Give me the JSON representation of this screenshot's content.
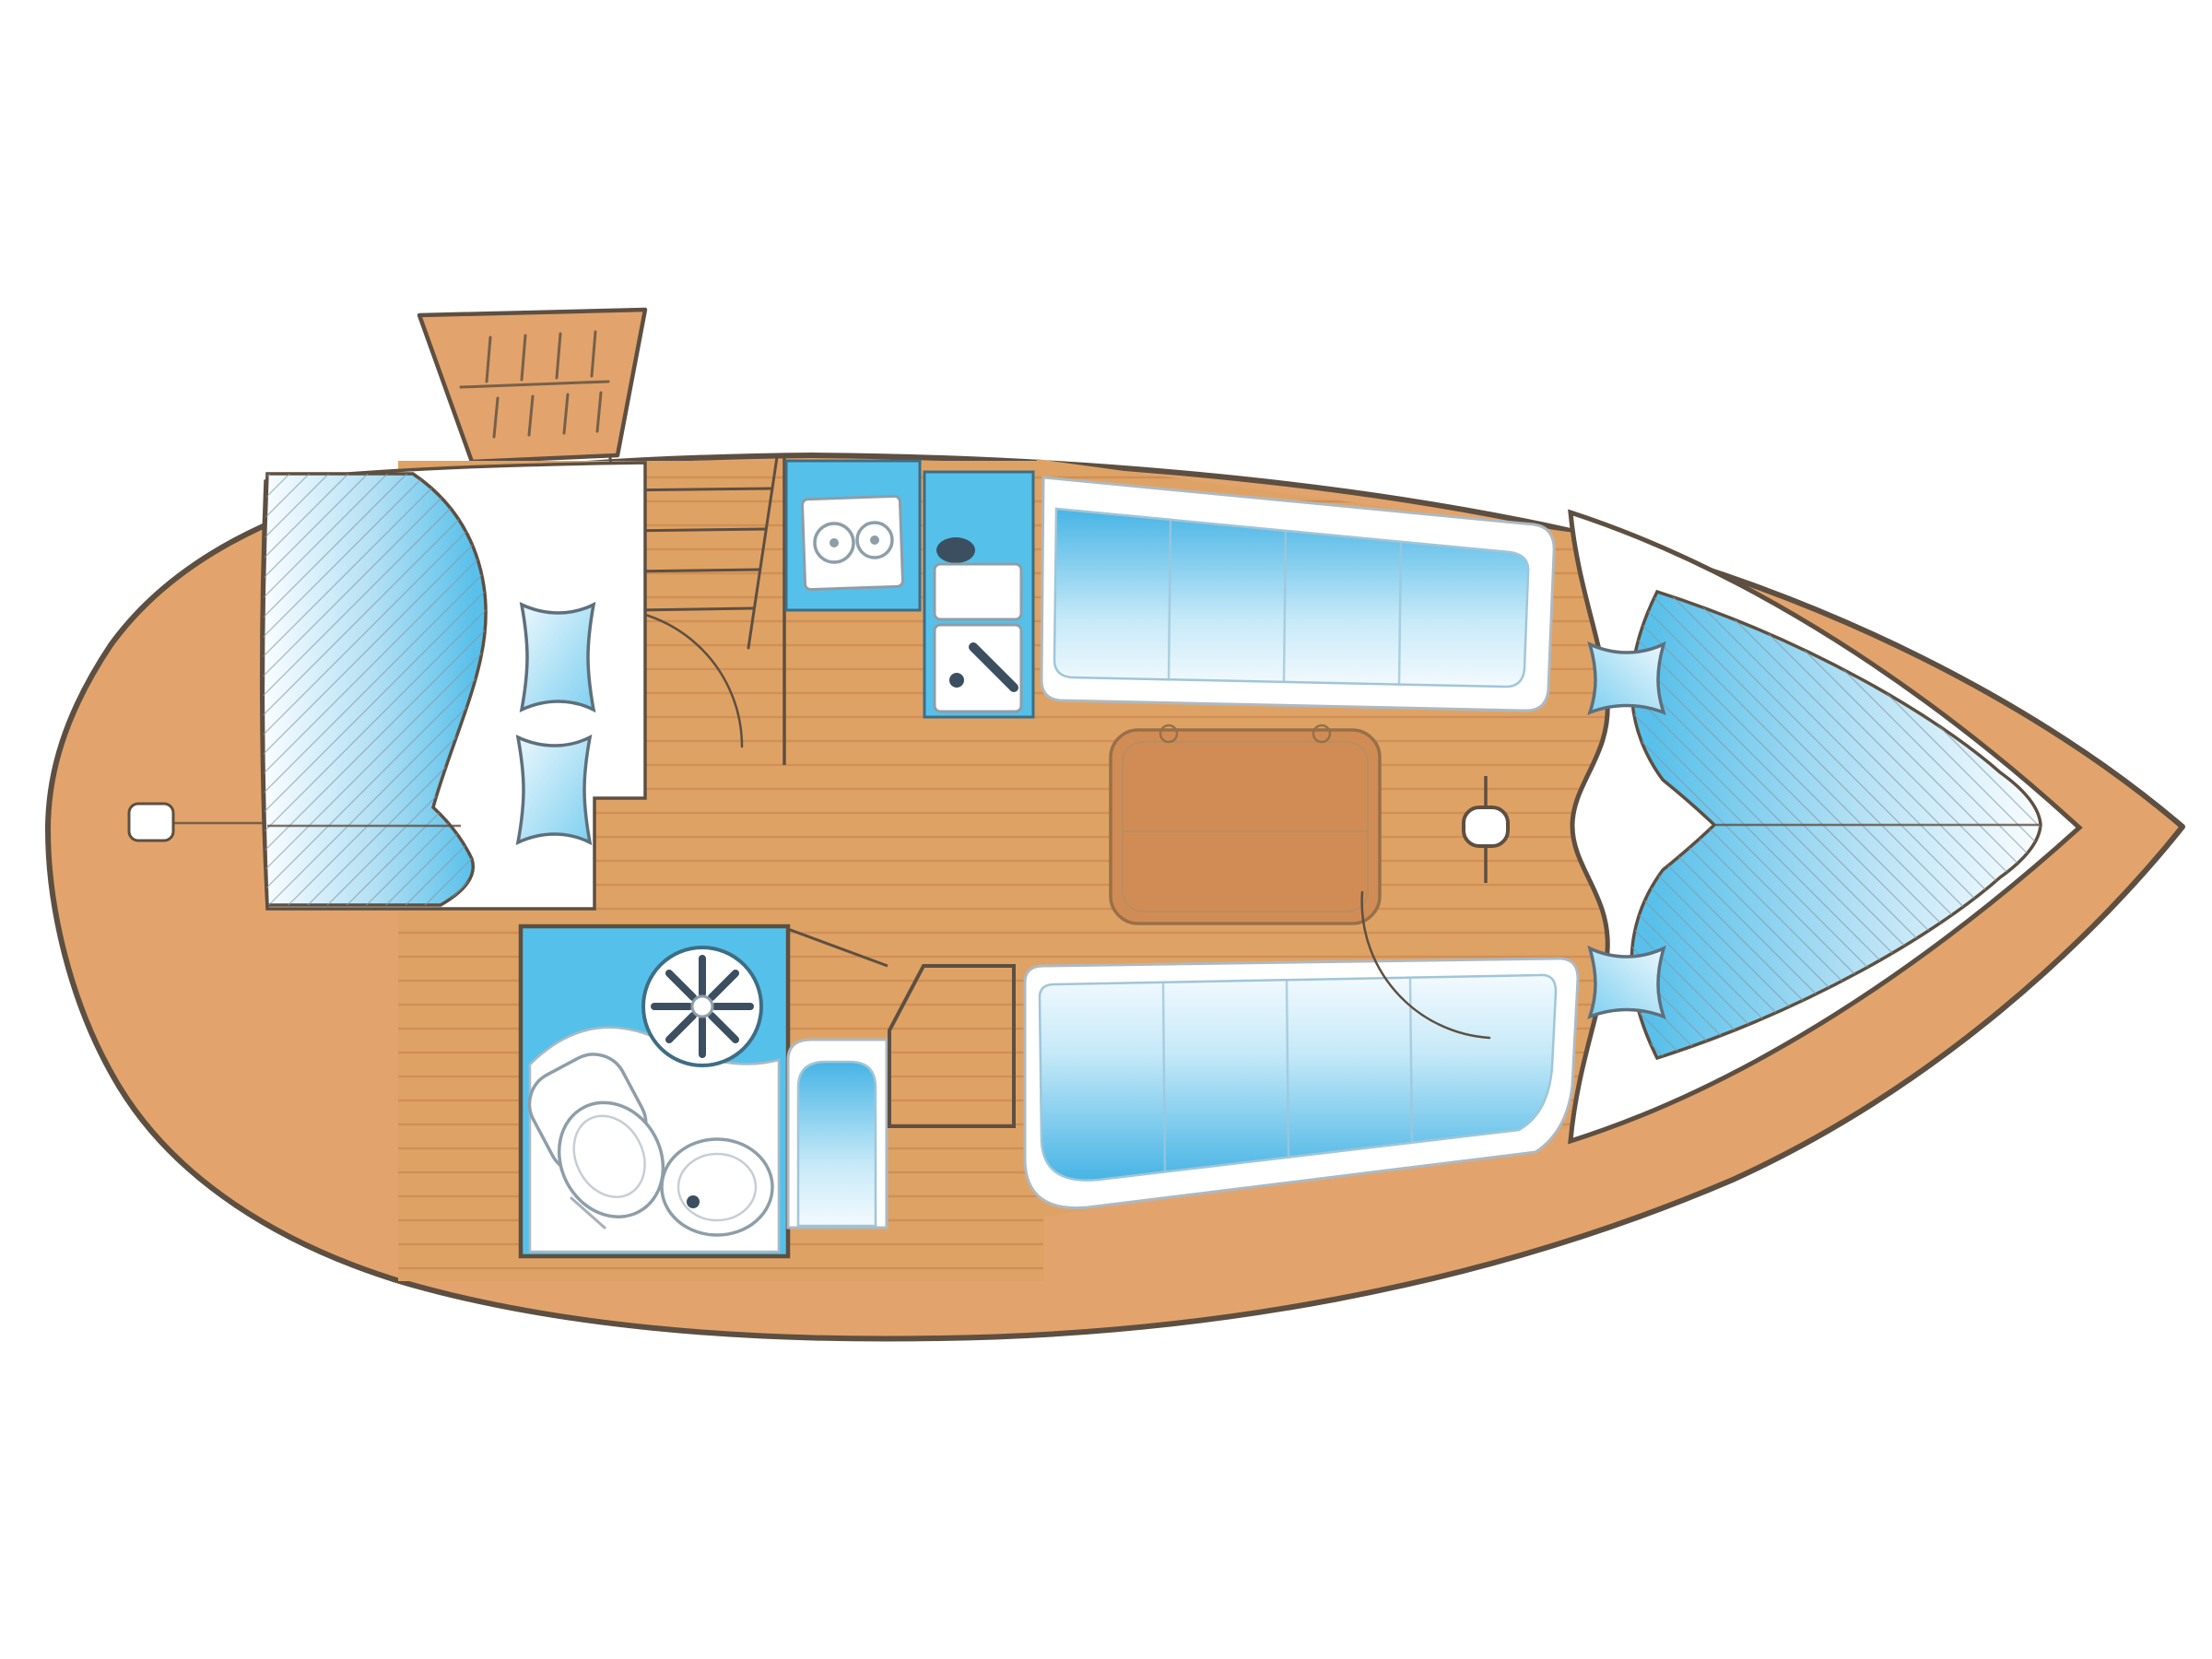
{
  "diagram": {
    "type": "boat-interior-floor-plan",
    "orientation": "bow-right",
    "areas": [
      {
        "id": "hull",
        "label": "hull"
      },
      {
        "id": "cockpit-hatch",
        "label": "companionway hatch"
      },
      {
        "id": "companionway-steps",
        "label": "companionway steps"
      },
      {
        "id": "aft-cabin-berth",
        "label": "aft double berth"
      },
      {
        "id": "heads",
        "label": "heads / bathroom"
      },
      {
        "id": "shower-drain",
        "label": "shower drain wheel"
      },
      {
        "id": "toilet",
        "label": "toilet"
      },
      {
        "id": "washbasin",
        "label": "washbasin"
      },
      {
        "id": "nav-seat",
        "label": "navigator seat"
      },
      {
        "id": "chart-table",
        "label": "chart table"
      },
      {
        "id": "galley-stove",
        "label": "galley stove"
      },
      {
        "id": "galley-sink",
        "label": "galley sink"
      },
      {
        "id": "upper-settee",
        "label": "starboard settee"
      },
      {
        "id": "salon-table",
        "label": "saloon table"
      },
      {
        "id": "lower-settee",
        "label": "port settee"
      },
      {
        "id": "mast",
        "label": "mast post"
      },
      {
        "id": "forward-door",
        "label": "forward cabin door swing"
      },
      {
        "id": "v-berth",
        "label": "forward V-berth"
      },
      {
        "id": "stern-step",
        "label": "stern transom step"
      }
    ]
  },
  "colors": {
    "hull": "#E2A46C",
    "hull_outline": "#5D4F41",
    "floor": "#DFA265",
    "floor_line": "#C18048",
    "white": "#FFFFFF",
    "furniture_stroke": "#AEB9C0",
    "counter_blue": "#55C1EA",
    "counter_stroke": "#3E6D84",
    "heads_floor": "#55C1EA",
    "fixture_dark": "#3C4F60",
    "fixture_stroke": "#8E9EA8",
    "cushion_deep": "#47B4E5",
    "cushion_mid": "#C6E9F8",
    "cushion_pale": "#F3FAFE",
    "mattress_deep": "#58C0EA",
    "mattress_mid": "#B3E0F4",
    "mattress_pale": "#FAFDFF",
    "hatch_line": "#8099A9",
    "pillow_blue": "#7FD0F0",
    "pillow_light": "#EAF7FD",
    "pillow_stroke": "#5E6F7C",
    "table": "#D18C55",
    "table_stroke": "#977049",
    "wall": "#5D4F41"
  }
}
